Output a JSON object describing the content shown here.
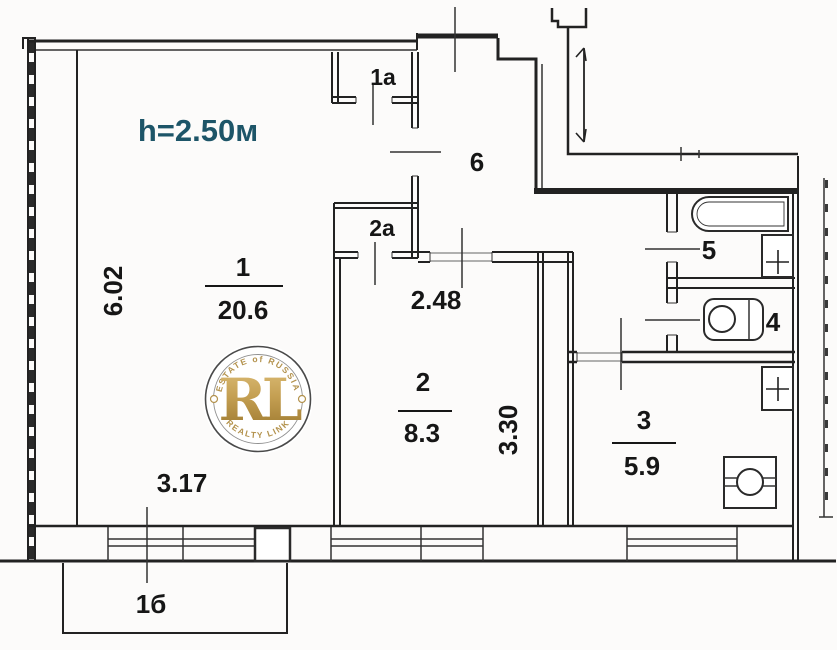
{
  "plan": {
    "ceiling_height_label": "h=2.50м",
    "rooms": [
      {
        "number": "1",
        "area": "20.6"
      },
      {
        "number": "2",
        "area": "8.3"
      },
      {
        "number": "3",
        "area": "5.9"
      },
      {
        "number": "4"
      },
      {
        "number": "5"
      },
      {
        "number": "6"
      },
      {
        "number": "1a"
      },
      {
        "number": "2a"
      },
      {
        "number": "1б"
      }
    ],
    "dimensions": {
      "room1_height": "6.02",
      "room1_width": "3.17",
      "room2_width": "2.48",
      "room2_height": "3.30"
    },
    "colors": {
      "height_label": "#1d5568",
      "line": "#222222",
      "watermark_gold": "#b3924d"
    },
    "watermark": {
      "initials": "RL",
      "arc_top": "ESTATE of RUSSIA",
      "arc_bottom": "REALTY LINK"
    }
  }
}
